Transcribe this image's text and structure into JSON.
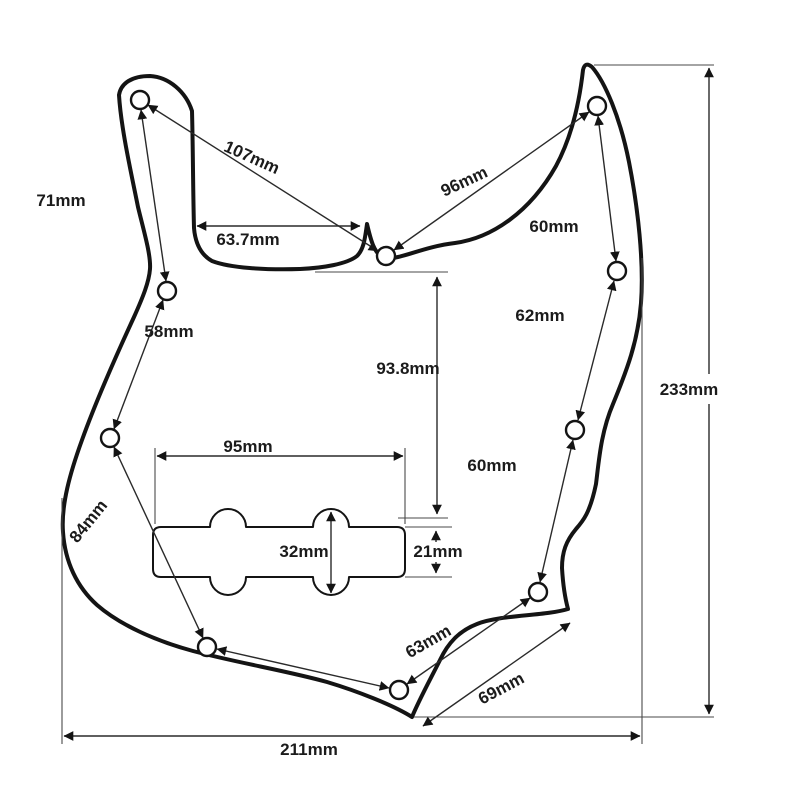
{
  "diagram": {
    "type": "technical-drawing",
    "subject": "jazz-bass-pickguard-dimensions",
    "unit": "mm",
    "background_color": "#ffffff",
    "line_color": "#141414",
    "screw_hole_count": 10,
    "pickup_cutout": {
      "width_label": "95mm",
      "height_label": "32mm",
      "slot_height_label": "21mm"
    },
    "overall": {
      "width_label": "211mm",
      "height_label": "233mm"
    }
  },
  "labels": {
    "m71": "71mm",
    "m107": "107mm",
    "m63_7": "63.7mm",
    "m96": "96mm",
    "m60_upper_right": "60mm",
    "m58": "58mm",
    "m62": "62mm",
    "m93_8": "93.8mm",
    "m233": "233mm",
    "m95": "95mm",
    "m60_lower_right": "60mm",
    "m84": "84mm",
    "m32": "32mm",
    "m21": "21mm",
    "m63": "63mm",
    "m69": "69mm",
    "m211": "211mm"
  }
}
